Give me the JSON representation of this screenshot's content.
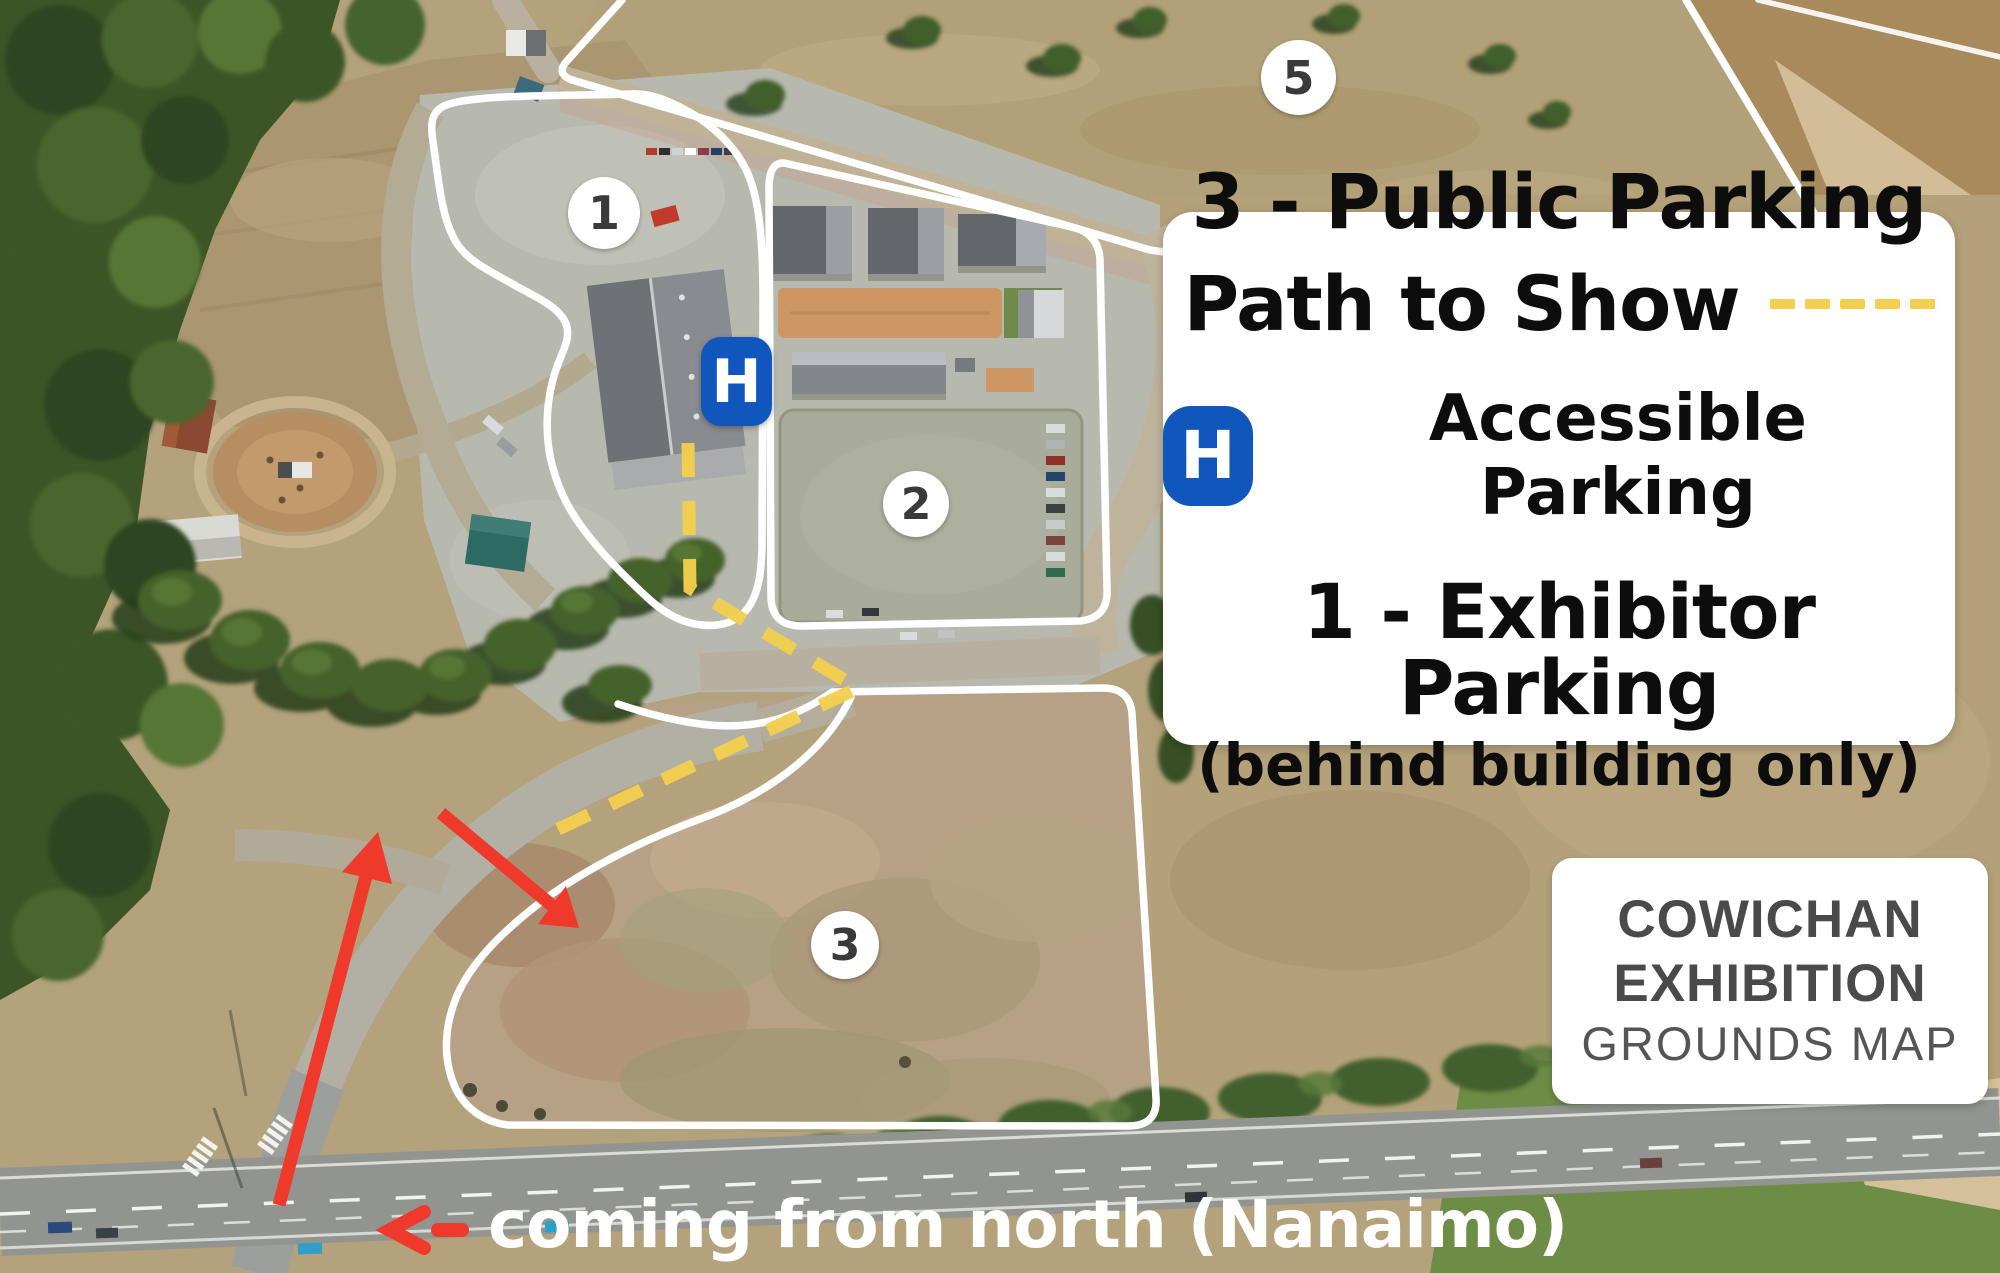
{
  "legend": {
    "public_parking_label": "3 - Public Parking",
    "path_to_show_label": "Path to Show",
    "accessible_symbol": "H",
    "accessible_label": "Accessible Parking",
    "exhibitor_parking_label": "1 - Exhibitor Parking",
    "exhibitor_parking_note": "(behind building only)"
  },
  "title_card": {
    "line1": "COWICHAN",
    "line2": "EXHIBITION",
    "line3": "GROUNDS MAP"
  },
  "caption": {
    "text": "coming from north (Nanaimo)"
  },
  "markers": {
    "area1": {
      "label": "1"
    },
    "area2": {
      "label": "2"
    },
    "area3": {
      "label": "3"
    },
    "area5": {
      "label": "5"
    },
    "accessible": {
      "symbol": "H"
    }
  },
  "colors": {
    "path_yellow": "#F2CF4E",
    "accessible_blue": "#1156BC",
    "route_red": "#EF392B",
    "boundary_white": "#FFFFFF",
    "title_gray": "#4A4A4A"
  }
}
